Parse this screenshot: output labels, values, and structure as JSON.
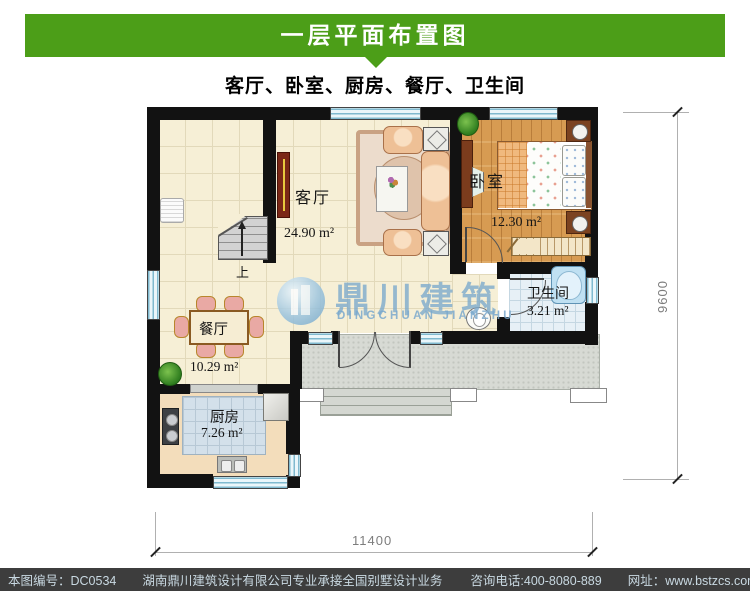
{
  "header": {
    "title": "一层平面布置图",
    "subtitle": "客厅、卧室、厨房、餐厅、卫生间"
  },
  "rooms": {
    "living": {
      "name": "客厅",
      "area": "24.90 m²"
    },
    "bedroom": {
      "name": "卧室",
      "area": "12.30 m²"
    },
    "bathroom": {
      "name": "卫生间",
      "area": "3.21 m²"
    },
    "dining": {
      "name": "餐厅",
      "area": "10.29 m²"
    },
    "kitchen": {
      "name": "厨房",
      "area": "7.26 m²"
    }
  },
  "stairs": {
    "direction_label": "上"
  },
  "dimensions": {
    "bottom": "11400",
    "right": "9600"
  },
  "watermark": {
    "cn": "鼎川建筑",
    "en": "DINGCHUAN JIANZHU"
  },
  "footer": {
    "serial": "本图编号：DC0534",
    "company": "湖南鼎川建筑设计有限公司专业承接全国别墅设计业务",
    "phone": "咨询电话:400-8080-889",
    "website": "网址：www.bstzcs.com"
  },
  "colors": {
    "accent_green": "#4c9e18",
    "wall_black": "#121212",
    "window_blue": "#7fb9cf",
    "footer_bg": "#3d3d3d",
    "footer_text": "#c9d9e2",
    "watermark_blue": "#7aa8cc"
  }
}
